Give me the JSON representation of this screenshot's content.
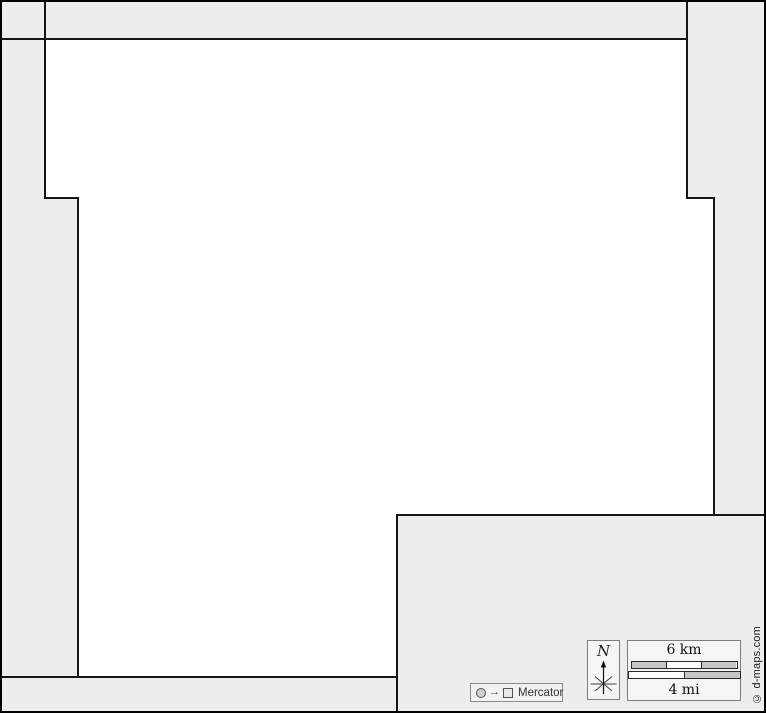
{
  "map": {
    "region_points": "45,39 687,39 687,198 714,198 714,515 397,515 397,677 78,677 78,198 45,198",
    "neighbor_boundaries": [
      "0,39 45,39",
      "45,0 45,39",
      "687,0 687,39",
      "0,677 78,677",
      "397,677 397,713",
      "714,515 766,515"
    ],
    "colors": {
      "background": "#ededed",
      "region_fill": "#ffffff",
      "boundary_line": "#151515",
      "frame": "#000000",
      "scale_segment_gray": "#c6c6c6"
    }
  },
  "compass": {
    "north_label": "N"
  },
  "scale_bar": {
    "km_label": "6 km",
    "mi_label": "4 mi",
    "km_segments": 3,
    "mi_segments": 2
  },
  "projection_badge": {
    "arrow_glyph": "→",
    "label": "Mercator"
  },
  "copyright_label": "© d-maps.com"
}
